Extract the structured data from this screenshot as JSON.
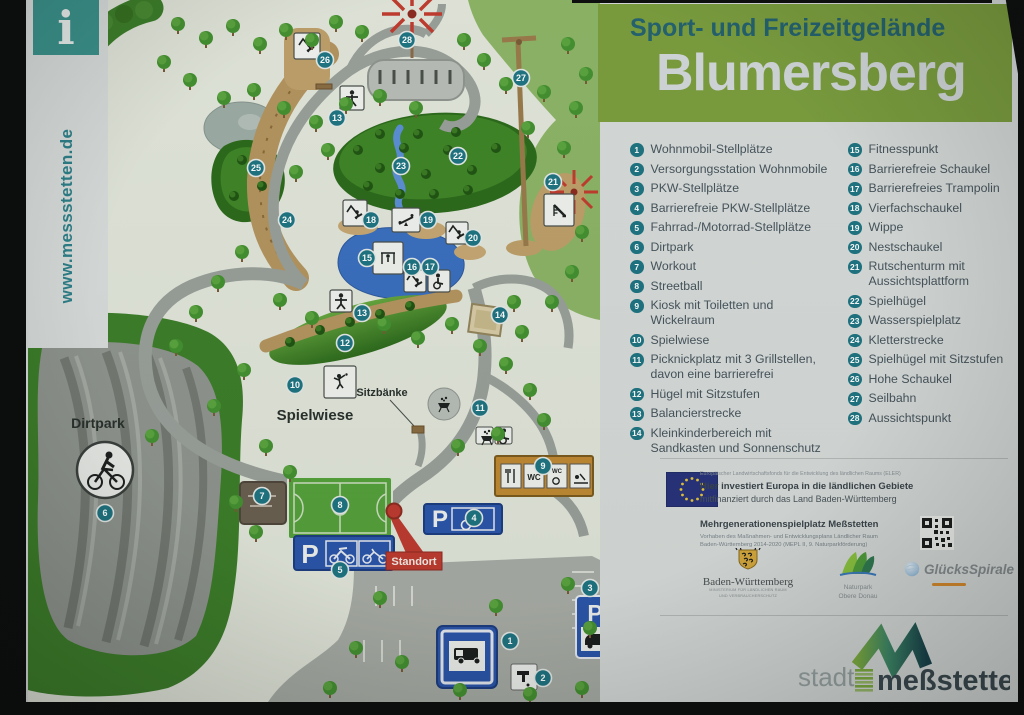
{
  "sidebar": {
    "info_symbol": "i",
    "website": "www.messstetten.de"
  },
  "header": {
    "subtitle": "Sport- und Freizeitgelände",
    "title": "Blumersberg"
  },
  "legend": {
    "col1": [
      {
        "num": "1",
        "label": "Wohnmobil-Stellplätze"
      },
      {
        "num": "2",
        "label": "Versorgungsstation Wohnmobile"
      },
      {
        "num": "3",
        "label": "PKW-Stellplätze"
      },
      {
        "num": "4",
        "label": "Barrierefreie PKW-Stellplätze"
      },
      {
        "num": "5",
        "label": "Fahrrad-/Motorrad-Stellplätze"
      },
      {
        "num": "6",
        "label": "Dirtpark"
      },
      {
        "num": "7",
        "label": "Workout"
      },
      {
        "num": "8",
        "label": "Streetball"
      },
      {
        "num": "9",
        "label": "Kiosk mit Toiletten und Wickelraum"
      },
      {
        "num": "10",
        "label": "Spielwiese"
      },
      {
        "num": "11",
        "label": "Picknickplatz mit 3 Grillstellen, davon eine barrierefrei"
      },
      {
        "num": "12",
        "label": "Hügel mit Sitzstufen"
      },
      {
        "num": "13",
        "label": "Balancierstrecke"
      },
      {
        "num": "14",
        "label": "Kleinkinderbereich mit Sandkasten und Sonnenschutz"
      }
    ],
    "col2": [
      {
        "num": "15",
        "label": "Fitnesspunkt"
      },
      {
        "num": "16",
        "label": "Barrierefreie Schaukel"
      },
      {
        "num": "17",
        "label": "Barrierefreies Trampolin"
      },
      {
        "num": "18",
        "label": "Vierfachschaukel"
      },
      {
        "num": "19",
        "label": "Wippe"
      },
      {
        "num": "20",
        "label": "Nestschaukel"
      },
      {
        "num": "21",
        "label": "Rutschenturm mit Aussichtsplattform"
      },
      {
        "num": "22",
        "label": "Spielhügel"
      },
      {
        "num": "23",
        "label": "Wasserspielplatz"
      },
      {
        "num": "24",
        "label": "Kletterstrecke"
      },
      {
        "num": "25",
        "label": "Spielhügel mit Sitzstufen"
      },
      {
        "num": "26",
        "label": "Hohe Schaukel"
      },
      {
        "num": "27",
        "label": "Seilbahn"
      },
      {
        "num": "28",
        "label": "Aussichtspunkt"
      }
    ]
  },
  "map": {
    "labels": {
      "dirtpark": "Dirtpark",
      "spielwiese": "Spielwiese",
      "sitzbaenke": "Sitzbänke",
      "standort": "Standort"
    },
    "sign_letters": {
      "parking": "P",
      "wc": "WC"
    },
    "markers": [
      {
        "n": "1",
        "x": 482,
        "y": 641
      },
      {
        "n": "2",
        "x": 515,
        "y": 678
      },
      {
        "n": "3",
        "x": 562,
        "y": 588
      },
      {
        "n": "4",
        "x": 446,
        "y": 518
      },
      {
        "n": "5",
        "x": 312,
        "y": 570
      },
      {
        "n": "6",
        "x": 77,
        "y": 513
      },
      {
        "n": "7",
        "x": 234,
        "y": 496
      },
      {
        "n": "8",
        "x": 312,
        "y": 505
      },
      {
        "n": "9",
        "x": 515,
        "y": 466
      },
      {
        "n": "10",
        "x": 267,
        "y": 385
      },
      {
        "n": "11",
        "x": 452,
        "y": 408
      },
      {
        "n": "12",
        "x": 317,
        "y": 343
      },
      {
        "n": "13",
        "x": 309,
        "y": 118
      },
      {
        "n": "13",
        "x": 334,
        "y": 313
      },
      {
        "n": "14",
        "x": 472,
        "y": 315
      },
      {
        "n": "15",
        "x": 339,
        "y": 258
      },
      {
        "n": "16",
        "x": 384,
        "y": 267
      },
      {
        "n": "17",
        "x": 402,
        "y": 267
      },
      {
        "n": "18",
        "x": 343,
        "y": 220
      },
      {
        "n": "19",
        "x": 400,
        "y": 220
      },
      {
        "n": "20",
        "x": 445,
        "y": 238
      },
      {
        "n": "21",
        "x": 525,
        "y": 182
      },
      {
        "n": "22",
        "x": 430,
        "y": 156
      },
      {
        "n": "23",
        "x": 373,
        "y": 166
      },
      {
        "n": "24",
        "x": 259,
        "y": 220
      },
      {
        "n": "25",
        "x": 228,
        "y": 168
      },
      {
        "n": "26",
        "x": 297,
        "y": 60
      },
      {
        "n": "27",
        "x": 493,
        "y": 78
      },
      {
        "n": "28",
        "x": 379,
        "y": 40
      }
    ]
  },
  "funding": {
    "eler_line": "Europäischer Landwirtschaftsfonds für die Entwicklung des ländlichen Raums (ELER)",
    "invest_line": "Hier investiert Europa in die ländlichen Gebiete",
    "cofinance_line": "mitfinanziert durch das Land Baden-Württemberg",
    "project_line": "Mehrgenerationenspielplatz Meßstetten",
    "program_line1": "Vorhaben des Maßnahmen- und Entwicklungsplans Ländlicher Raum",
    "program_line2": "Baden-Württemberg 2014-2020 (MEPL II, 9. Naturparkförderung)"
  },
  "partners": {
    "bw_name": "Baden-Württemberg",
    "bw_caption1": "MINISTERIUM FÜR LÄNDLICHEN RAUM",
    "bw_caption2": "UND VERBRAUCHERSCHUTZ",
    "naturpark_line1": "Naturpark",
    "naturpark_line2": "Obere Donau",
    "lottery_name": "GlücksSpirale"
  },
  "footer": {
    "stadt_label": "stadt",
    "city_name": "meßstetten"
  }
}
